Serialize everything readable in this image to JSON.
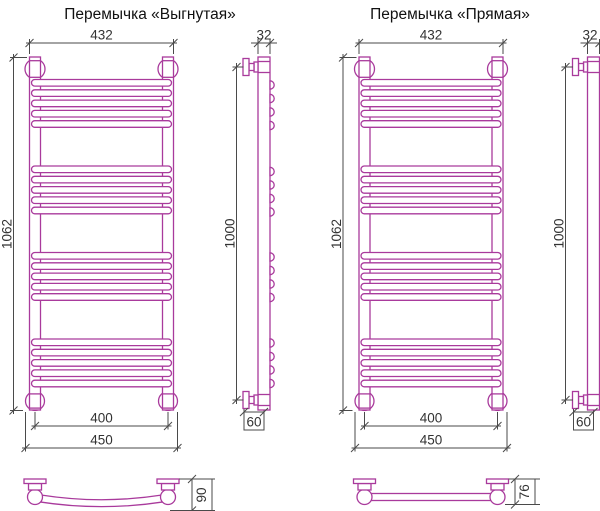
{
  "drawing": {
    "background": "#ffffff",
    "line_color": "#a93a9c",
    "dim_color": "#4a4a4a",
    "text_color": "#333333",
    "models": {
      "curved": {
        "title": "Перемычка «Выгнутая»",
        "dims": {
          "width_outer": "432",
          "height_total": "1062",
          "width_axes": "400",
          "width_overall": "450",
          "tube_diameter": "32",
          "mount_distance": "1000",
          "wall_offset": "60",
          "crossbar_depth": "90"
        }
      },
      "straight": {
        "title": "Перемычка «Прямая»",
        "dims": {
          "width_outer": "432",
          "height_total": "1062",
          "width_axes": "400",
          "width_overall": "450",
          "tube_diameter": "32",
          "mount_distance": "1000",
          "wall_offset": "60",
          "crossbar_depth": "76"
        }
      }
    }
  }
}
